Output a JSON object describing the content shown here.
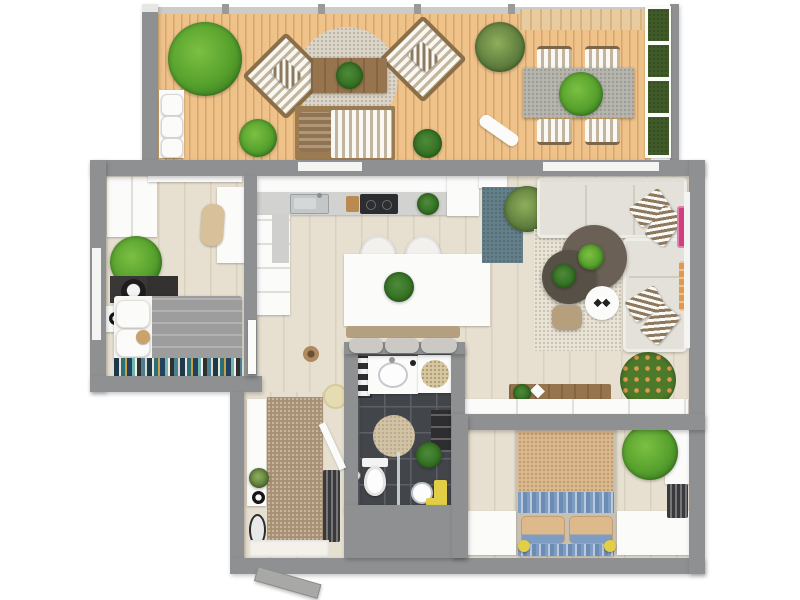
{
  "scene": {
    "type": "3d-rendered-floor-plan-top-view",
    "rooms": [
      {
        "id": "balcony-terrace",
        "furniture": [
          "wood-deck",
          "planter-hedges",
          "striped-armchairs",
          "outdoor-coffee-table",
          "daybed",
          "outdoor-dining-table",
          "dining-chairs",
          "bench",
          "plants",
          "gravel-rug",
          "pergola"
        ]
      },
      {
        "id": "kitchen",
        "furniture": [
          "l-shaped-counter",
          "sink",
          "cooktop",
          "cutting-board",
          "counter-plant"
        ]
      },
      {
        "id": "dining-area",
        "furniture": [
          "white-island-table",
          "two-chairs",
          "banquette-bench",
          "teal-runner-rug",
          "palm-plant"
        ]
      },
      {
        "id": "living-room",
        "furniture": [
          "l-shaped-sectional-sofa",
          "striped-pillows",
          "round-coffee-tables",
          "white-side-table",
          "pouf",
          "cream-rug",
          "sideboard",
          "low-cabinet",
          "wreath-plant",
          "pink-wall-art",
          "orange-wall-art"
        ]
      },
      {
        "id": "bedroom-left",
        "furniture": [
          "wardrobe",
          "cabinet",
          "chaise",
          "desk",
          "office-chair",
          "bed-gray",
          "pillows",
          "teddy-bear",
          "bookshelf",
          "nightstand",
          "plant"
        ]
      },
      {
        "id": "bedroom-right",
        "furniture": [
          "double-bed-tan-blue",
          "pillows",
          "nightstands",
          "wardrobe",
          "radiator",
          "plant",
          "yellow-lamps"
        ]
      },
      {
        "id": "bathroom",
        "furniture": [
          "vanity-sink",
          "towel-shelf",
          "corner-shower",
          "round-rug",
          "toilet",
          "glass-partition",
          "pedestal-sink",
          "yellow-towel",
          "shelf-plant"
        ]
      },
      {
        "id": "hallway-entry",
        "furniture": [
          "runner-rug",
          "console",
          "mirror",
          "radiator",
          "stool",
          "entry-door",
          "door-mat",
          "plant"
        ]
      }
    ]
  },
  "palette": {
    "wall": "#8f9091",
    "deck": "#eec289",
    "pergola": "#e9cba0",
    "floor": "#e7e0d1",
    "bath_floor": "#42464b",
    "bath_grout": "#5d6167",
    "rug_cream": "#ebe5d6",
    "rug_teal": "#64808a",
    "rug_hall": "#a78f72",
    "rug_gravel": "#ddd6c8",
    "sofa": "#e4e1da",
    "sofa_line": "#cfccc3",
    "table_dark": "#6a6055",
    "table_darker": "#575046",
    "pouf": "#b59f7d",
    "wood": "#96754e",
    "wood_gray": "#b7b6ae",
    "stripe_brown": "#8d7a5e",
    "bed_gray": "#9d9d9d",
    "bed_tan": "#ddb98c",
    "bed_blue": "#7f9dc2",
    "leaf_bright": "#7cc043",
    "leaf_mid": "#55a02c",
    "leaf_dark": "#2f6c1e",
    "leaf_olive": "#5d7c3c",
    "hedge": "#405a28",
    "accent_pink": "#d0407e",
    "accent_orange": "#e09a4e",
    "accent_yellow": "#e2cf45",
    "radiator": "#3a3a3c",
    "shelf_dark": "#2e2e31",
    "counter": "#d2d3d1",
    "steel": "#c3c7c8",
    "cooktop": "#2c2d31",
    "mat_beige": "#d8c8a2"
  }
}
